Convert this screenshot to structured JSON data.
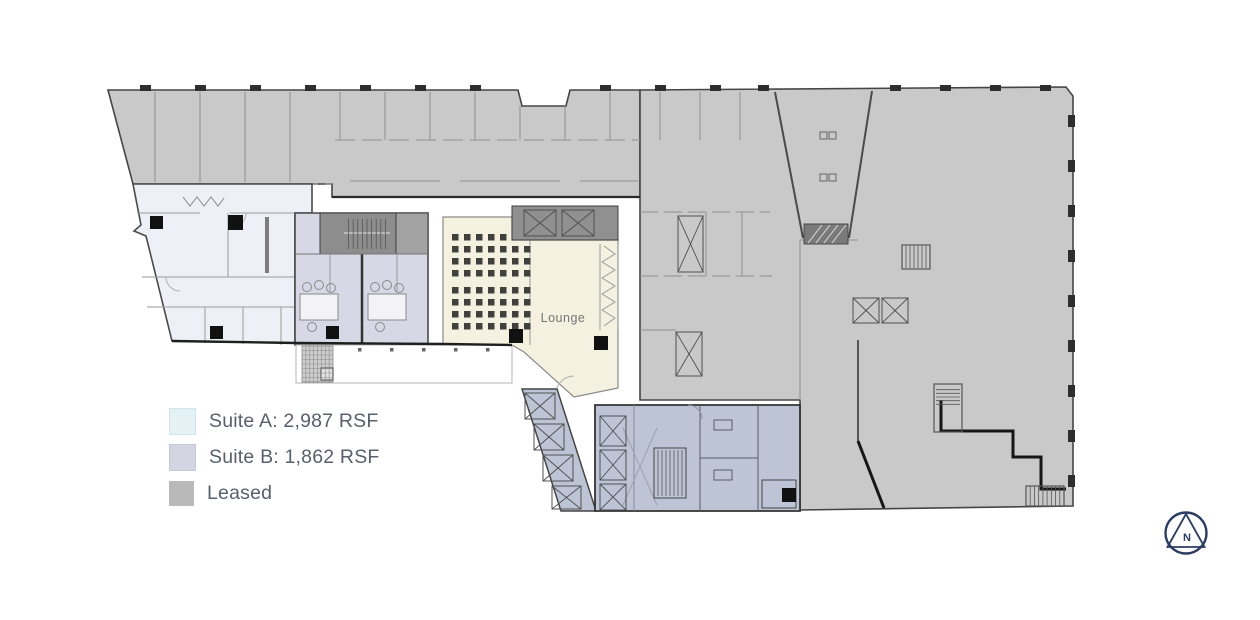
{
  "legend": {
    "items": [
      {
        "id": "suite-a",
        "label": "Suite A: 2,987 RSF",
        "color": "#e4f2f5"
      },
      {
        "id": "suite-b",
        "label": "Suite B: 1,862 RSF",
        "color": "#d4d5e3"
      },
      {
        "id": "leased",
        "label": "Leased",
        "color": "#b9b9b9"
      }
    ]
  },
  "plan": {
    "lounge_label": "Lounge",
    "region_colors": {
      "leased": "#c9c9c9",
      "suite_a": "#edf1f7",
      "suite_b": "#d7d7e6",
      "lounge_cream": "#f4f1e0",
      "core_blue_gray": "#bdc4d5",
      "stair_block": "#8d8d8d"
    }
  },
  "compass": {
    "label": "N",
    "color": "#2c3c62"
  }
}
